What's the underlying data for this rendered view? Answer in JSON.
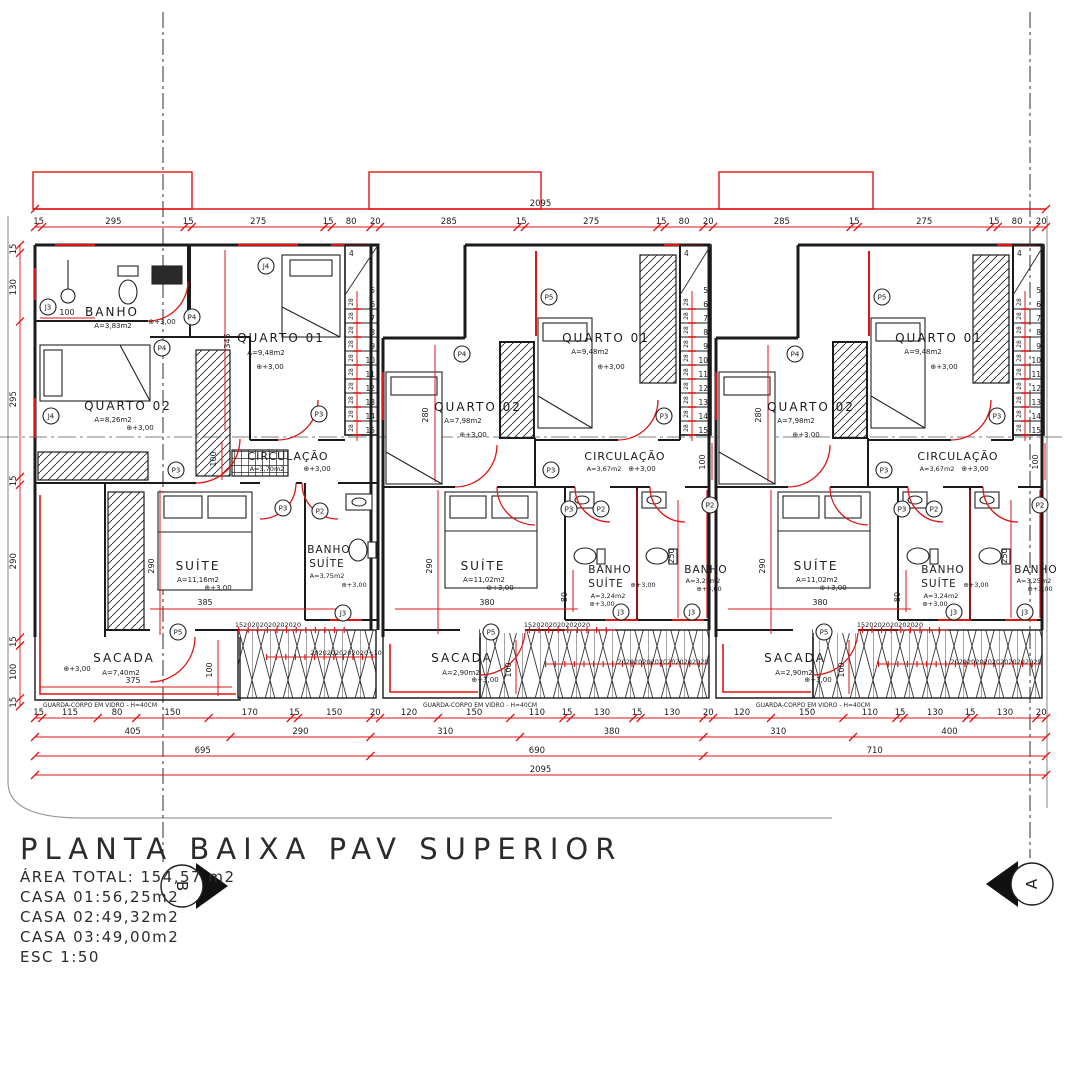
{
  "palette": {
    "red": "#e01414",
    "black": "#1b1b1b",
    "gray": "#9a9a9a",
    "white": "#ffffff"
  },
  "title_block": {
    "title": "PLANTA BAIXA PAV SUPERIOR",
    "lines": [
      "ÁREA TOTAL: 154,57 m2",
      "CASA 01:56,25m2",
      "CASA 02:49,32m2",
      "CASA 03:49,00m2",
      "ESC 1:50"
    ]
  },
  "section_markers": {
    "left": "B",
    "right": "A"
  },
  "stairs": {
    "top_number": "4",
    "first_number": "5",
    "numbers": [
      "6",
      "7",
      "8",
      "9",
      "10",
      "11",
      "12",
      "13",
      "14",
      "15"
    ],
    "riser_label": "28"
  },
  "chains": [
    {
      "o": "h",
      "x": 35,
      "y": 227,
      "s": 0.4826,
      "v": [
        15,
        295,
        15,
        275,
        15,
        80,
        20,
        285,
        15,
        275,
        15,
        80,
        20,
        285,
        15,
        275,
        15,
        80,
        20
      ]
    },
    {
      "o": "h",
      "x": 35,
      "y": 209,
      "s": 0.4826,
      "v": [
        2095
      ]
    },
    {
      "o": "h",
      "x": 35,
      "y": 718,
      "s": 0.4826,
      "v": [
        15,
        115,
        80,
        150,
        170,
        15,
        150,
        20,
        120,
        150,
        110,
        15,
        130,
        15,
        130,
        20,
        120,
        150,
        110,
        15,
        130,
        15,
        130,
        20
      ]
    },
    {
      "o": "h",
      "x": 35,
      "y": 737,
      "s": 0.4826,
      "v": [
        405,
        290,
        310,
        380,
        310,
        400
      ]
    },
    {
      "o": "h",
      "x": 35,
      "y": 756,
      "s": 0.4826,
      "v": [
        695,
        690,
        710
      ]
    },
    {
      "o": "h",
      "x": 35,
      "y": 775,
      "s": 0.4826,
      "v": [
        2095
      ]
    },
    {
      "o": "v",
      "x": 20,
      "y": 245,
      "s": 0.527,
      "v": [
        15,
        130,
        295,
        15,
        290,
        15,
        100,
        15
      ]
    }
  ],
  "labels": [
    {
      "t": "BANHO",
      "x": 112,
      "y": 316,
      "s": 12,
      "ls": 2
    },
    {
      "t": "A=3,83m2",
      "x": 113,
      "y": 328,
      "s": 7
    },
    {
      "t": "⊕+3,00",
      "x": 162,
      "y": 324,
      "s": 7
    },
    {
      "t": "100",
      "x": 67,
      "y": 315,
      "s": 8
    },
    {
      "t": "QUARTO 01",
      "x": 281,
      "y": 342,
      "s": 12,
      "ls": 2
    },
    {
      "t": "A=9,48m2",
      "x": 266,
      "y": 355,
      "s": 7
    },
    {
      "t": "⊕+3,00",
      "x": 270,
      "y": 369,
      "s": 7
    },
    {
      "t": "345",
      "x": 230,
      "y": 341,
      "s": 8,
      "r": -90
    },
    {
      "t": "QUARTO 02",
      "x": 128,
      "y": 410,
      "s": 12,
      "ls": 2
    },
    {
      "t": "A=8,26m2",
      "x": 113,
      "y": 422,
      "s": 7
    },
    {
      "t": "⊕+3,00",
      "x": 140,
      "y": 430,
      "s": 7
    },
    {
      "t": "CIRCULAÇÃO",
      "x": 288,
      "y": 460,
      "s": 11,
      "ls": 1
    },
    {
      "t": "A=3,70m2",
      "x": 267,
      "y": 471,
      "s": 6.5
    },
    {
      "t": "⊕+3,00",
      "x": 317,
      "y": 471,
      "s": 7
    },
    {
      "t": "100",
      "x": 216,
      "y": 459,
      "s": 8,
      "r": -90
    },
    {
      "t": "SUÍTE",
      "x": 198,
      "y": 570,
      "s": 12,
      "ls": 2
    },
    {
      "t": "A=11,16m2",
      "x": 198,
      "y": 582,
      "s": 7
    },
    {
      "t": "⊕+3,00",
      "x": 218,
      "y": 590,
      "s": 7
    },
    {
      "t": "290",
      "x": 154,
      "y": 566,
      "s": 8,
      "r": -90
    },
    {
      "t": "385",
      "x": 205,
      "y": 605,
      "s": 8
    },
    {
      "t": "BANHO",
      "x": 329,
      "y": 553,
      "s": 10.5,
      "ls": 1
    },
    {
      "t": "SUÍTE",
      "x": 327,
      "y": 567,
      "s": 10.5,
      "ls": 1
    },
    {
      "t": "A=3,75m2",
      "x": 327,
      "y": 578,
      "s": 6.5
    },
    {
      "t": "⊕+3,00",
      "x": 354,
      "y": 587,
      "s": 6.5
    },
    {
      "t": "SACADA",
      "x": 124,
      "y": 662,
      "s": 12,
      "ls": 2
    },
    {
      "t": "A=7,40m2",
      "x": 121,
      "y": 675,
      "s": 7
    },
    {
      "t": "⊕+3,00",
      "x": 77,
      "y": 671,
      "s": 7
    },
    {
      "t": "375",
      "x": 133,
      "y": 683,
      "s": 8
    },
    {
      "t": "100",
      "x": 212,
      "y": 670,
      "s": 8,
      "r": -90
    },
    {
      "t": "1520202020202020",
      "x": 268,
      "y": 627,
      "s": 6.5
    },
    {
      "t": "20202020202020+10",
      "x": 346,
      "y": 655,
      "s": 6.5,
      "c": "r"
    },
    {
      "t": "GUARDA-CORPO EM VIDRO - H=40CM",
      "x": 100,
      "y": 707,
      "s": 6
    },
    {
      "t": "QUARTO 01",
      "x": 606,
      "y": 342,
      "s": 12,
      "ls": 2
    },
    {
      "t": "A=9,48m2",
      "x": 590,
      "y": 354,
      "s": 7
    },
    {
      "t": "⊕+3,00",
      "x": 611,
      "y": 369,
      "s": 7
    },
    {
      "t": "QUARTO 02",
      "x": 478,
      "y": 411,
      "s": 12,
      "ls": 2
    },
    {
      "t": "A=7,98m2",
      "x": 463,
      "y": 423,
      "s": 7
    },
    {
      "t": "⊕+3,00",
      "x": 473,
      "y": 437,
      "s": 7
    },
    {
      "t": "280",
      "x": 428,
      "y": 415,
      "s": 8,
      "r": -90
    },
    {
      "t": "CIRCULAÇÃO",
      "x": 625,
      "y": 460,
      "s": 11,
      "ls": 1
    },
    {
      "t": "A=3,67m2",
      "x": 604,
      "y": 471,
      "s": 6.5
    },
    {
      "t": "⊕+3,00",
      "x": 642,
      "y": 471,
      "s": 7
    },
    {
      "t": "100",
      "x": 705,
      "y": 462,
      "s": 8,
      "r": -90
    },
    {
      "t": "SUÍTE",
      "x": 483,
      "y": 570,
      "s": 12,
      "ls": 2
    },
    {
      "t": "A=11,02m2",
      "x": 484,
      "y": 582,
      "s": 7
    },
    {
      "t": "⊕+3,00",
      "x": 500,
      "y": 590,
      "s": 7
    },
    {
      "t": "290",
      "x": 432,
      "y": 566,
      "s": 8,
      "r": -90
    },
    {
      "t": "380",
      "x": 487,
      "y": 605,
      "s": 8
    },
    {
      "t": "80",
      "x": 567,
      "y": 597,
      "s": 8,
      "r": -90
    },
    {
      "t": "BANHO",
      "x": 610,
      "y": 573,
      "s": 10.5,
      "ls": 1
    },
    {
      "t": "SUÍTE",
      "x": 606,
      "y": 587,
      "s": 10.5,
      "ls": 1
    },
    {
      "t": "⊕+3,00",
      "x": 643,
      "y": 587,
      "s": 6.5
    },
    {
      "t": "A=3,24m2",
      "x": 608,
      "y": 598,
      "s": 6.5
    },
    {
      "t": "⊕+3,00",
      "x": 602,
      "y": 606,
      "s": 6.5
    },
    {
      "t": "250",
      "x": 674,
      "y": 556,
      "s": 8,
      "r": -90
    },
    {
      "t": "BANHO",
      "x": 706,
      "y": 573,
      "s": 10.5,
      "ls": 1
    },
    {
      "t": "A=3,25m2",
      "x": 703,
      "y": 583,
      "s": 6.5
    },
    {
      "t": "⊕+3,00",
      "x": 709,
      "y": 591,
      "s": 6.5
    },
    {
      "t": "SACADA",
      "x": 462,
      "y": 662,
      "s": 12,
      "ls": 2
    },
    {
      "t": "A=2,90m2",
      "x": 461,
      "y": 675,
      "s": 7
    },
    {
      "t": "⊕+3,00",
      "x": 485,
      "y": 682,
      "s": 7
    },
    {
      "t": "100",
      "x": 511,
      "y": 670,
      "s": 8,
      "r": -90
    },
    {
      "t": "1520202020202020",
      "x": 557,
      "y": 627,
      "s": 6.5
    },
    {
      "t": "2020202020202020202020",
      "x": 663,
      "y": 664,
      "s": 6.5,
      "c": "r"
    },
    {
      "t": "GUARDA-CORPO EM VIDRO - H=40CM",
      "x": 480,
      "y": 707,
      "s": 6
    },
    {
      "t": "QUARTO 01",
      "x": 939,
      "y": 342,
      "s": 12,
      "ls": 2
    },
    {
      "t": "A=9,48m2",
      "x": 923,
      "y": 354,
      "s": 7
    },
    {
      "t": "⊕+3,00",
      "x": 944,
      "y": 369,
      "s": 7
    },
    {
      "t": "QUARTO 02",
      "x": 811,
      "y": 411,
      "s": 12,
      "ls": 2
    },
    {
      "t": "A=7,98m2",
      "x": 796,
      "y": 423,
      "s": 7
    },
    {
      "t": "⊕+3,00",
      "x": 806,
      "y": 437,
      "s": 7
    },
    {
      "t": "280",
      "x": 761,
      "y": 415,
      "s": 8,
      "r": -90
    },
    {
      "t": "CIRCULAÇÃO",
      "x": 958,
      "y": 460,
      "s": 11,
      "ls": 1
    },
    {
      "t": "A=3,67m2",
      "x": 937,
      "y": 471,
      "s": 6.5
    },
    {
      "t": "⊕+3,00",
      "x": 975,
      "y": 471,
      "s": 7
    },
    {
      "t": "100",
      "x": 1038,
      "y": 462,
      "s": 8,
      "r": -90
    },
    {
      "t": "SUÍTE",
      "x": 816,
      "y": 570,
      "s": 12,
      "ls": 2
    },
    {
      "t": "A=11,02m2",
      "x": 817,
      "y": 582,
      "s": 7
    },
    {
      "t": "⊕+3,00",
      "x": 833,
      "y": 590,
      "s": 7
    },
    {
      "t": "290",
      "x": 765,
      "y": 566,
      "s": 8,
      "r": -90
    },
    {
      "t": "380",
      "x": 820,
      "y": 605,
      "s": 8
    },
    {
      "t": "80",
      "x": 900,
      "y": 597,
      "s": 8,
      "r": -90
    },
    {
      "t": "BANHO",
      "x": 943,
      "y": 573,
      "s": 10.5,
      "ls": 1
    },
    {
      "t": "SUÍTE",
      "x": 939,
      "y": 587,
      "s": 10.5,
      "ls": 1
    },
    {
      "t": "⊕+3,00",
      "x": 976,
      "y": 587,
      "s": 6.5
    },
    {
      "t": "A=3,24m2",
      "x": 941,
      "y": 598,
      "s": 6.5
    },
    {
      "t": "⊕+3,00",
      "x": 935,
      "y": 606,
      "s": 6.5
    },
    {
      "t": "250",
      "x": 1007,
      "y": 556,
      "s": 8,
      "r": -90
    },
    {
      "t": "BANHO",
      "x": 1036,
      "y": 573,
      "s": 10.5,
      "ls": 1
    },
    {
      "t": "A=3,25m2",
      "x": 1034,
      "y": 583,
      "s": 6.5
    },
    {
      "t": "⊕+3,00",
      "x": 1040,
      "y": 591,
      "s": 6.5
    },
    {
      "t": "SACADA",
      "x": 795,
      "y": 662,
      "s": 12,
      "ls": 2
    },
    {
      "t": "A=2,90m2",
      "x": 794,
      "y": 675,
      "s": 7
    },
    {
      "t": "⊕+3,00",
      "x": 818,
      "y": 682,
      "s": 7
    },
    {
      "t": "100",
      "x": 844,
      "y": 670,
      "s": 8,
      "r": -90
    },
    {
      "t": "1520202020202020",
      "x": 890,
      "y": 627,
      "s": 6.5
    },
    {
      "t": "2020202020202020202020",
      "x": 996,
      "y": 664,
      "s": 6.5,
      "c": "r"
    },
    {
      "t": "GUARDA-CORPO EM VIDRO - H=40CM",
      "x": 813,
      "y": 707,
      "s": 6
    }
  ],
  "markers": [
    {
      "t": "J3",
      "x": 48,
      "y": 307
    },
    {
      "t": "P4",
      "x": 192,
      "y": 317
    },
    {
      "t": "P4",
      "x": 162,
      "y": 348
    },
    {
      "t": "J4",
      "x": 266,
      "y": 266
    },
    {
      "t": "J4",
      "x": 51,
      "y": 416
    },
    {
      "t": "P3",
      "x": 319,
      "y": 414
    },
    {
      "t": "P3",
      "x": 176,
      "y": 470
    },
    {
      "t": "P3",
      "x": 283,
      "y": 508
    },
    {
      "t": "P2",
      "x": 320,
      "y": 511
    },
    {
      "t": "J3",
      "x": 343,
      "y": 613
    },
    {
      "t": "P5",
      "x": 178,
      "y": 632
    },
    {
      "t": "P4",
      "x": 462,
      "y": 354
    },
    {
      "t": "P5",
      "x": 549,
      "y": 297
    },
    {
      "t": "P3",
      "x": 551,
      "y": 470
    },
    {
      "t": "P3",
      "x": 664,
      "y": 416
    },
    {
      "t": "P3",
      "x": 569,
      "y": 509
    },
    {
      "t": "P2",
      "x": 601,
      "y": 509
    },
    {
      "t": "P2",
      "x": 710,
      "y": 505
    },
    {
      "t": "J3",
      "x": 621,
      "y": 612
    },
    {
      "t": "J3",
      "x": 692,
      "y": 612
    },
    {
      "t": "P5",
      "x": 491,
      "y": 632
    },
    {
      "t": "P4",
      "x": 795,
      "y": 354
    },
    {
      "t": "P5",
      "x": 882,
      "y": 297
    },
    {
      "t": "P3",
      "x": 884,
      "y": 470
    },
    {
      "t": "P3",
      "x": 997,
      "y": 416
    },
    {
      "t": "P3",
      "x": 902,
      "y": 509
    },
    {
      "t": "P2",
      "x": 934,
      "y": 509
    },
    {
      "t": "P2",
      "x": 1040,
      "y": 505
    },
    {
      "t": "J3",
      "x": 954,
      "y": 612
    },
    {
      "t": "J3",
      "x": 1025,
      "y": 612
    },
    {
      "t": "P5",
      "x": 824,
      "y": 632
    },
    {
      "t": "B",
      "x": 182,
      "y": 886,
      "r": 21,
      "fs": 15,
      "rot": 90
    },
    {
      "t": "A",
      "x": 1032,
      "y": 884,
      "r": 21,
      "fs": 15,
      "rot": -90
    }
  ]
}
